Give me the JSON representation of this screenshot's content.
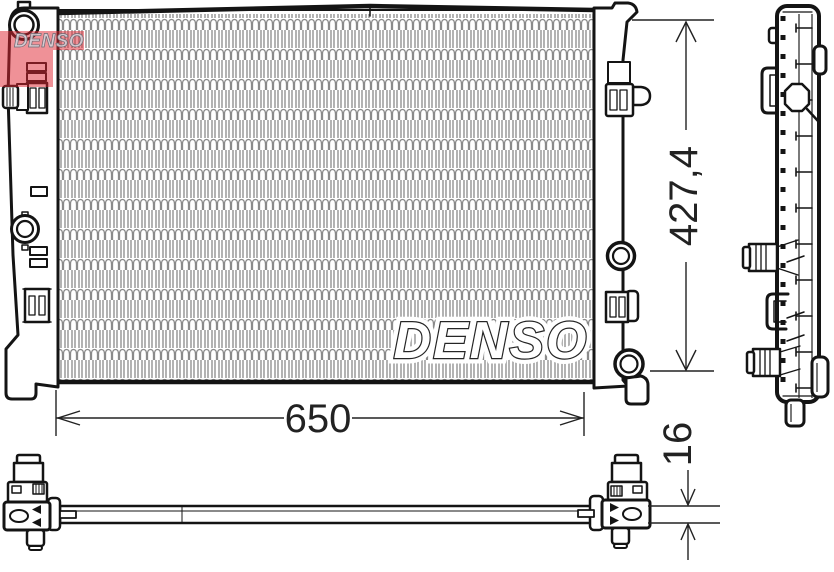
{
  "drawing": {
    "watermark": {
      "core_text": "DENSO",
      "logo_text": "DENSO"
    },
    "dimensions": {
      "width_label": "650",
      "height_label": "427,4",
      "thickness_label": "16"
    },
    "colors": {
      "line": "#141414",
      "fin_gray": "#8a8a8a",
      "logo_red": "#e02330",
      "background": "#ffffff"
    }
  }
}
